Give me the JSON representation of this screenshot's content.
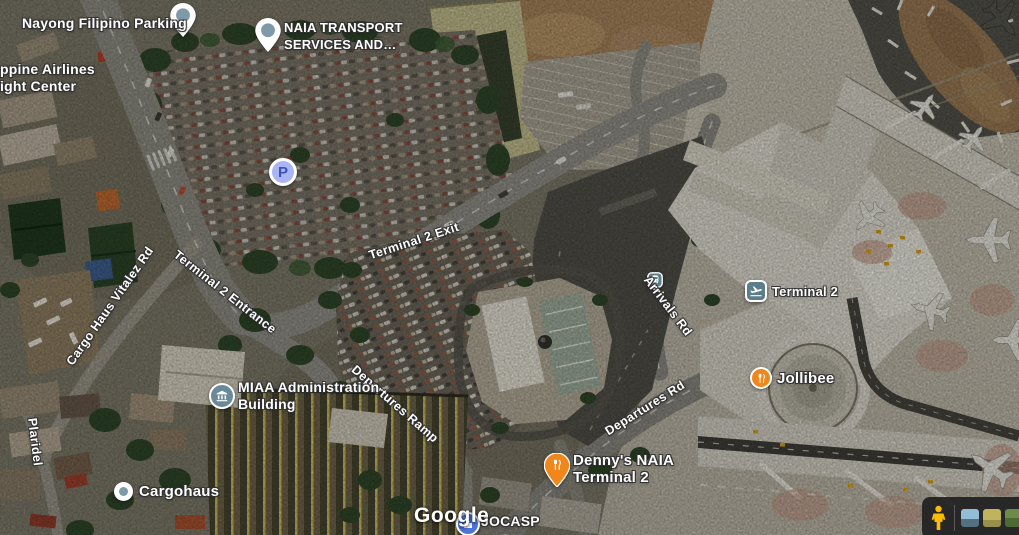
{
  "map": {
    "attribution": "Google"
  },
  "pois": {
    "nayong_filipino_parking": {
      "label": "Nayong Filipino Parking"
    },
    "naia_transport": {
      "line1": "NAIA TRANSPORT",
      "line2": "SERVICES AND…"
    },
    "philippine_airlines": {
      "line1": "ppine Airlines",
      "line2": "ight Center"
    },
    "parking": {
      "letter": "P"
    },
    "miaa_admin": {
      "line1": "MIAA Administration",
      "line2": "Building"
    },
    "cargohaus": {
      "label": "Cargohaus"
    },
    "jocasp": {
      "label": "JOCASP"
    },
    "terminal_2_station": {
      "label": "Terminal 2"
    },
    "jollibee": {
      "label": "Jollibee"
    },
    "dennys": {
      "line1": "Denny's NAIA",
      "line2": "Terminal 2"
    }
  },
  "roads": {
    "terminal_2_exit": "Terminal 2 Exit",
    "terminal_2_entrance": "Terminal 2 Entrance",
    "cargo_haus_vitalez_rd": "Cargo Haus Vitalez Rd",
    "departures_ramp": "Departures Ramp",
    "arrivals_rd": "Arrivals Rd",
    "departures_rd": "Departures Rd",
    "plaridel": "Plaridel"
  },
  "controls": {
    "street_view": {
      "thumbnail_count": 3
    }
  },
  "colors": {
    "restaurant_orange": "#F0871C",
    "poi_slate": "#5C7D8A",
    "parking_blue": "#A9B5F4",
    "parking_letter_blue": "#3F51B5",
    "pin_dot_slate": "#7E99A8",
    "jocasp_blue": "#4F74D8",
    "pegman_yellow": "#FBBC04"
  }
}
